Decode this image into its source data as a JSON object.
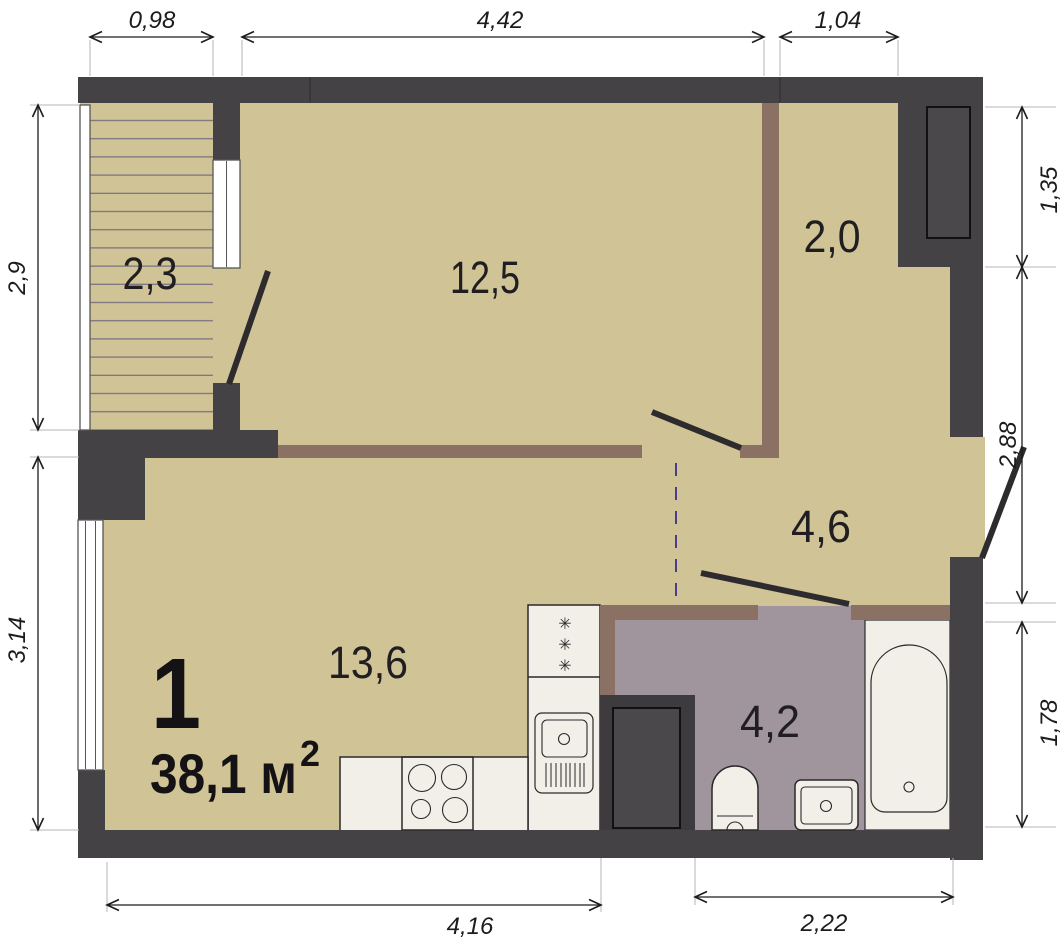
{
  "plan_title": "apartment-floor-plan",
  "summary": {
    "rooms_count": "1",
    "area_text": "38,1 м",
    "area_superscript": "2"
  },
  "room_areas": {
    "balcony": "2,3",
    "bedroom": "12,5",
    "wardrobe_hall": "2,0",
    "entry_hall": "4,6",
    "kitchen_living": "13,6",
    "bathroom": "4,2"
  },
  "dimensions": {
    "top_balcony_width": "0,98",
    "top_bedroom_width": "4,42",
    "top_hall_width": "1,04",
    "left_balcony_height": "2,9",
    "left_living_height": "3,14",
    "right_niche_height": "1,35",
    "right_hall_height": "2,88",
    "right_bathroom_height": "1,78",
    "bottom_living_width": "4,16",
    "bottom_bathroom_width": "2,22"
  },
  "icons": {
    "fridge_marker": "✳"
  },
  "colors": {
    "wall": "#454245",
    "wall_inner": "#4b484b",
    "floor": "#d0c496",
    "bath_floor": "#a0959d",
    "partition": "#8a7164",
    "fixture": "#f2efe9",
    "window": "#ffffff",
    "stripe": "#756e80",
    "door": "#2e2b2e",
    "dash": "#4a3d8f",
    "dim": "#1c1c1c",
    "ext": "#b4b4b4",
    "outline": "#2a2a2a"
  }
}
